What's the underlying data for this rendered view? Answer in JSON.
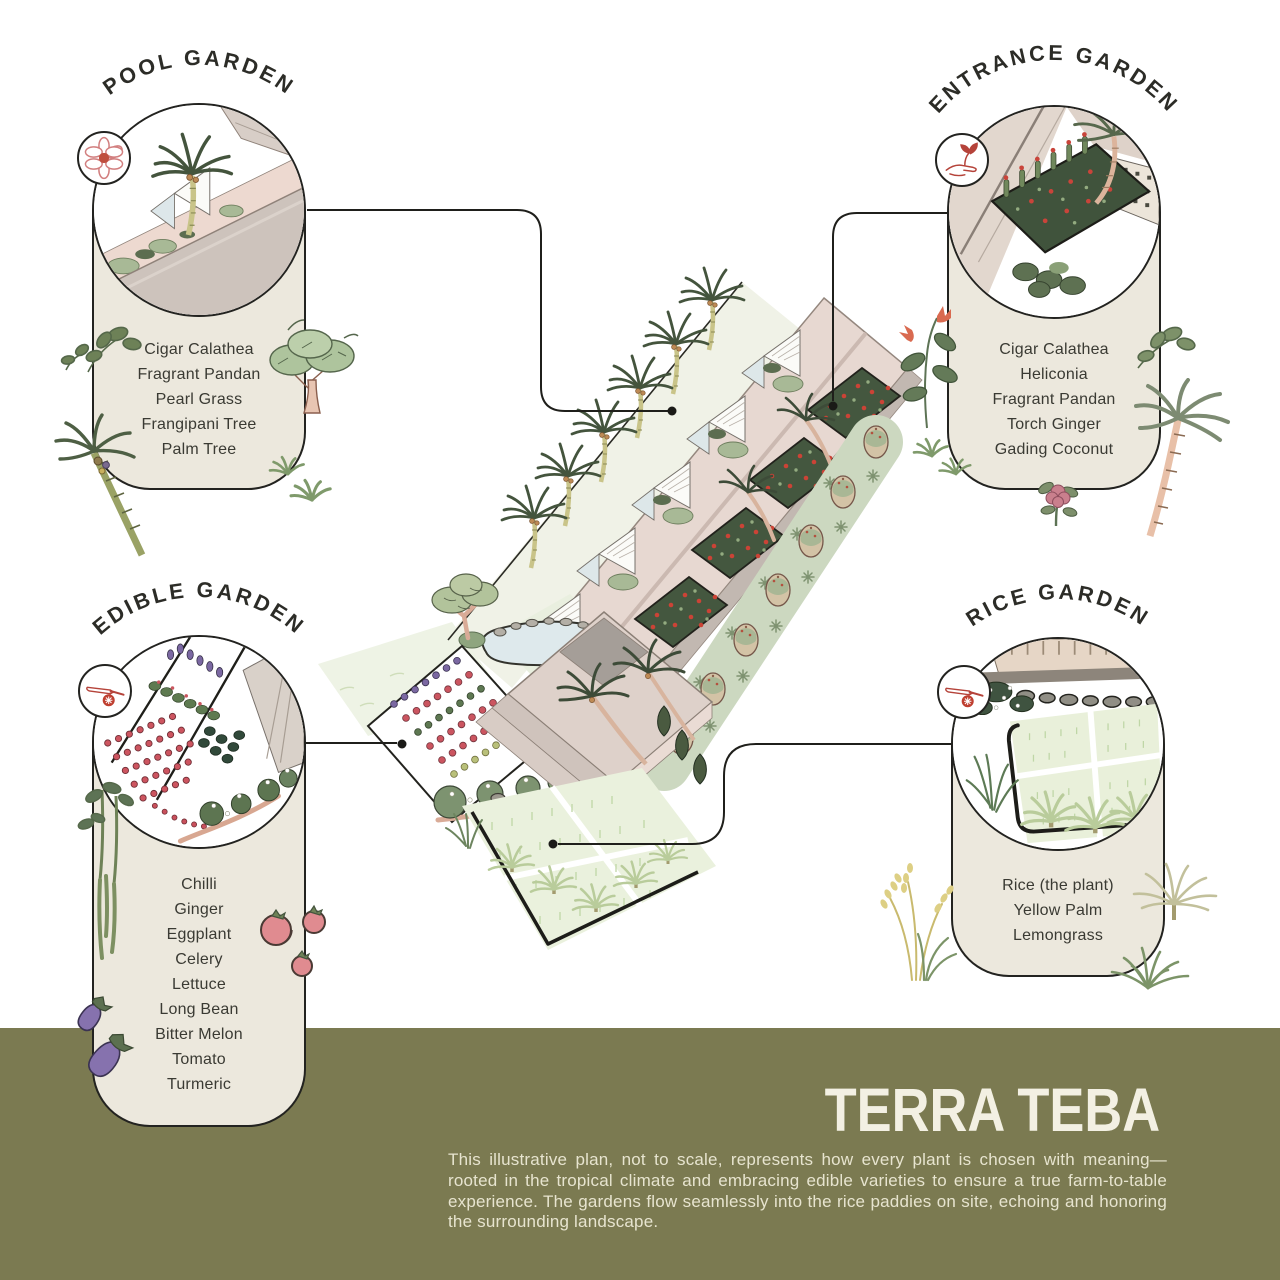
{
  "poster": {
    "colors": {
      "card_beige": "#ece8dd",
      "outline_black": "#232320",
      "olive_band": "#7b7a51",
      "accent_red": "#c0392b",
      "title_cream": "#f3f0e3",
      "roof_pink": "#e7d8d1",
      "roof_gray": "#cdc3bc",
      "paddy_green": "#eaf1dd",
      "water_blue": "#dee9ec"
    }
  },
  "cards": {
    "pool": {
      "title": "POOL GARDEN",
      "icon": "flower-icon",
      "plants": [
        "Cigar Calathea",
        "Fragrant Pandan",
        "Pearl Grass",
        "Frangipani Tree",
        "Palm Tree"
      ]
    },
    "entrance": {
      "title": "ENTRANCE GARDEN",
      "icon": "hand-seedling-icon",
      "plants": [
        "Cigar Calathea",
        "Heliconia",
        "Fragrant Pandan",
        "Torch Ginger",
        "Gading Coconut"
      ]
    },
    "edible": {
      "title": "EDIBLE GARDEN",
      "icon": "knife-tomato-icon",
      "plants": [
        "Chilli",
        "Ginger",
        "Eggplant",
        "Celery",
        "Lettuce",
        "Long Bean",
        "Bitter Melon",
        "Tomato",
        "Turmeric"
      ]
    },
    "rice": {
      "title": "RICE GARDEN",
      "icon": "knife-tomato-icon",
      "plants": [
        "Rice (the plant)",
        "Yellow Palm",
        "Lemongrass"
      ]
    }
  },
  "footer": {
    "title_light": "TERRA",
    "title_bold": "TEBA",
    "description": "This illustrative plan, not to scale, represents how every plant is chosen with meaning—rooted in the tropical climate and embracing edible varieties to ensure a true farm-to-table experience. The gardens flow seamlessly into the rice paddies on site, echoing and honoring the surrounding landscape."
  }
}
